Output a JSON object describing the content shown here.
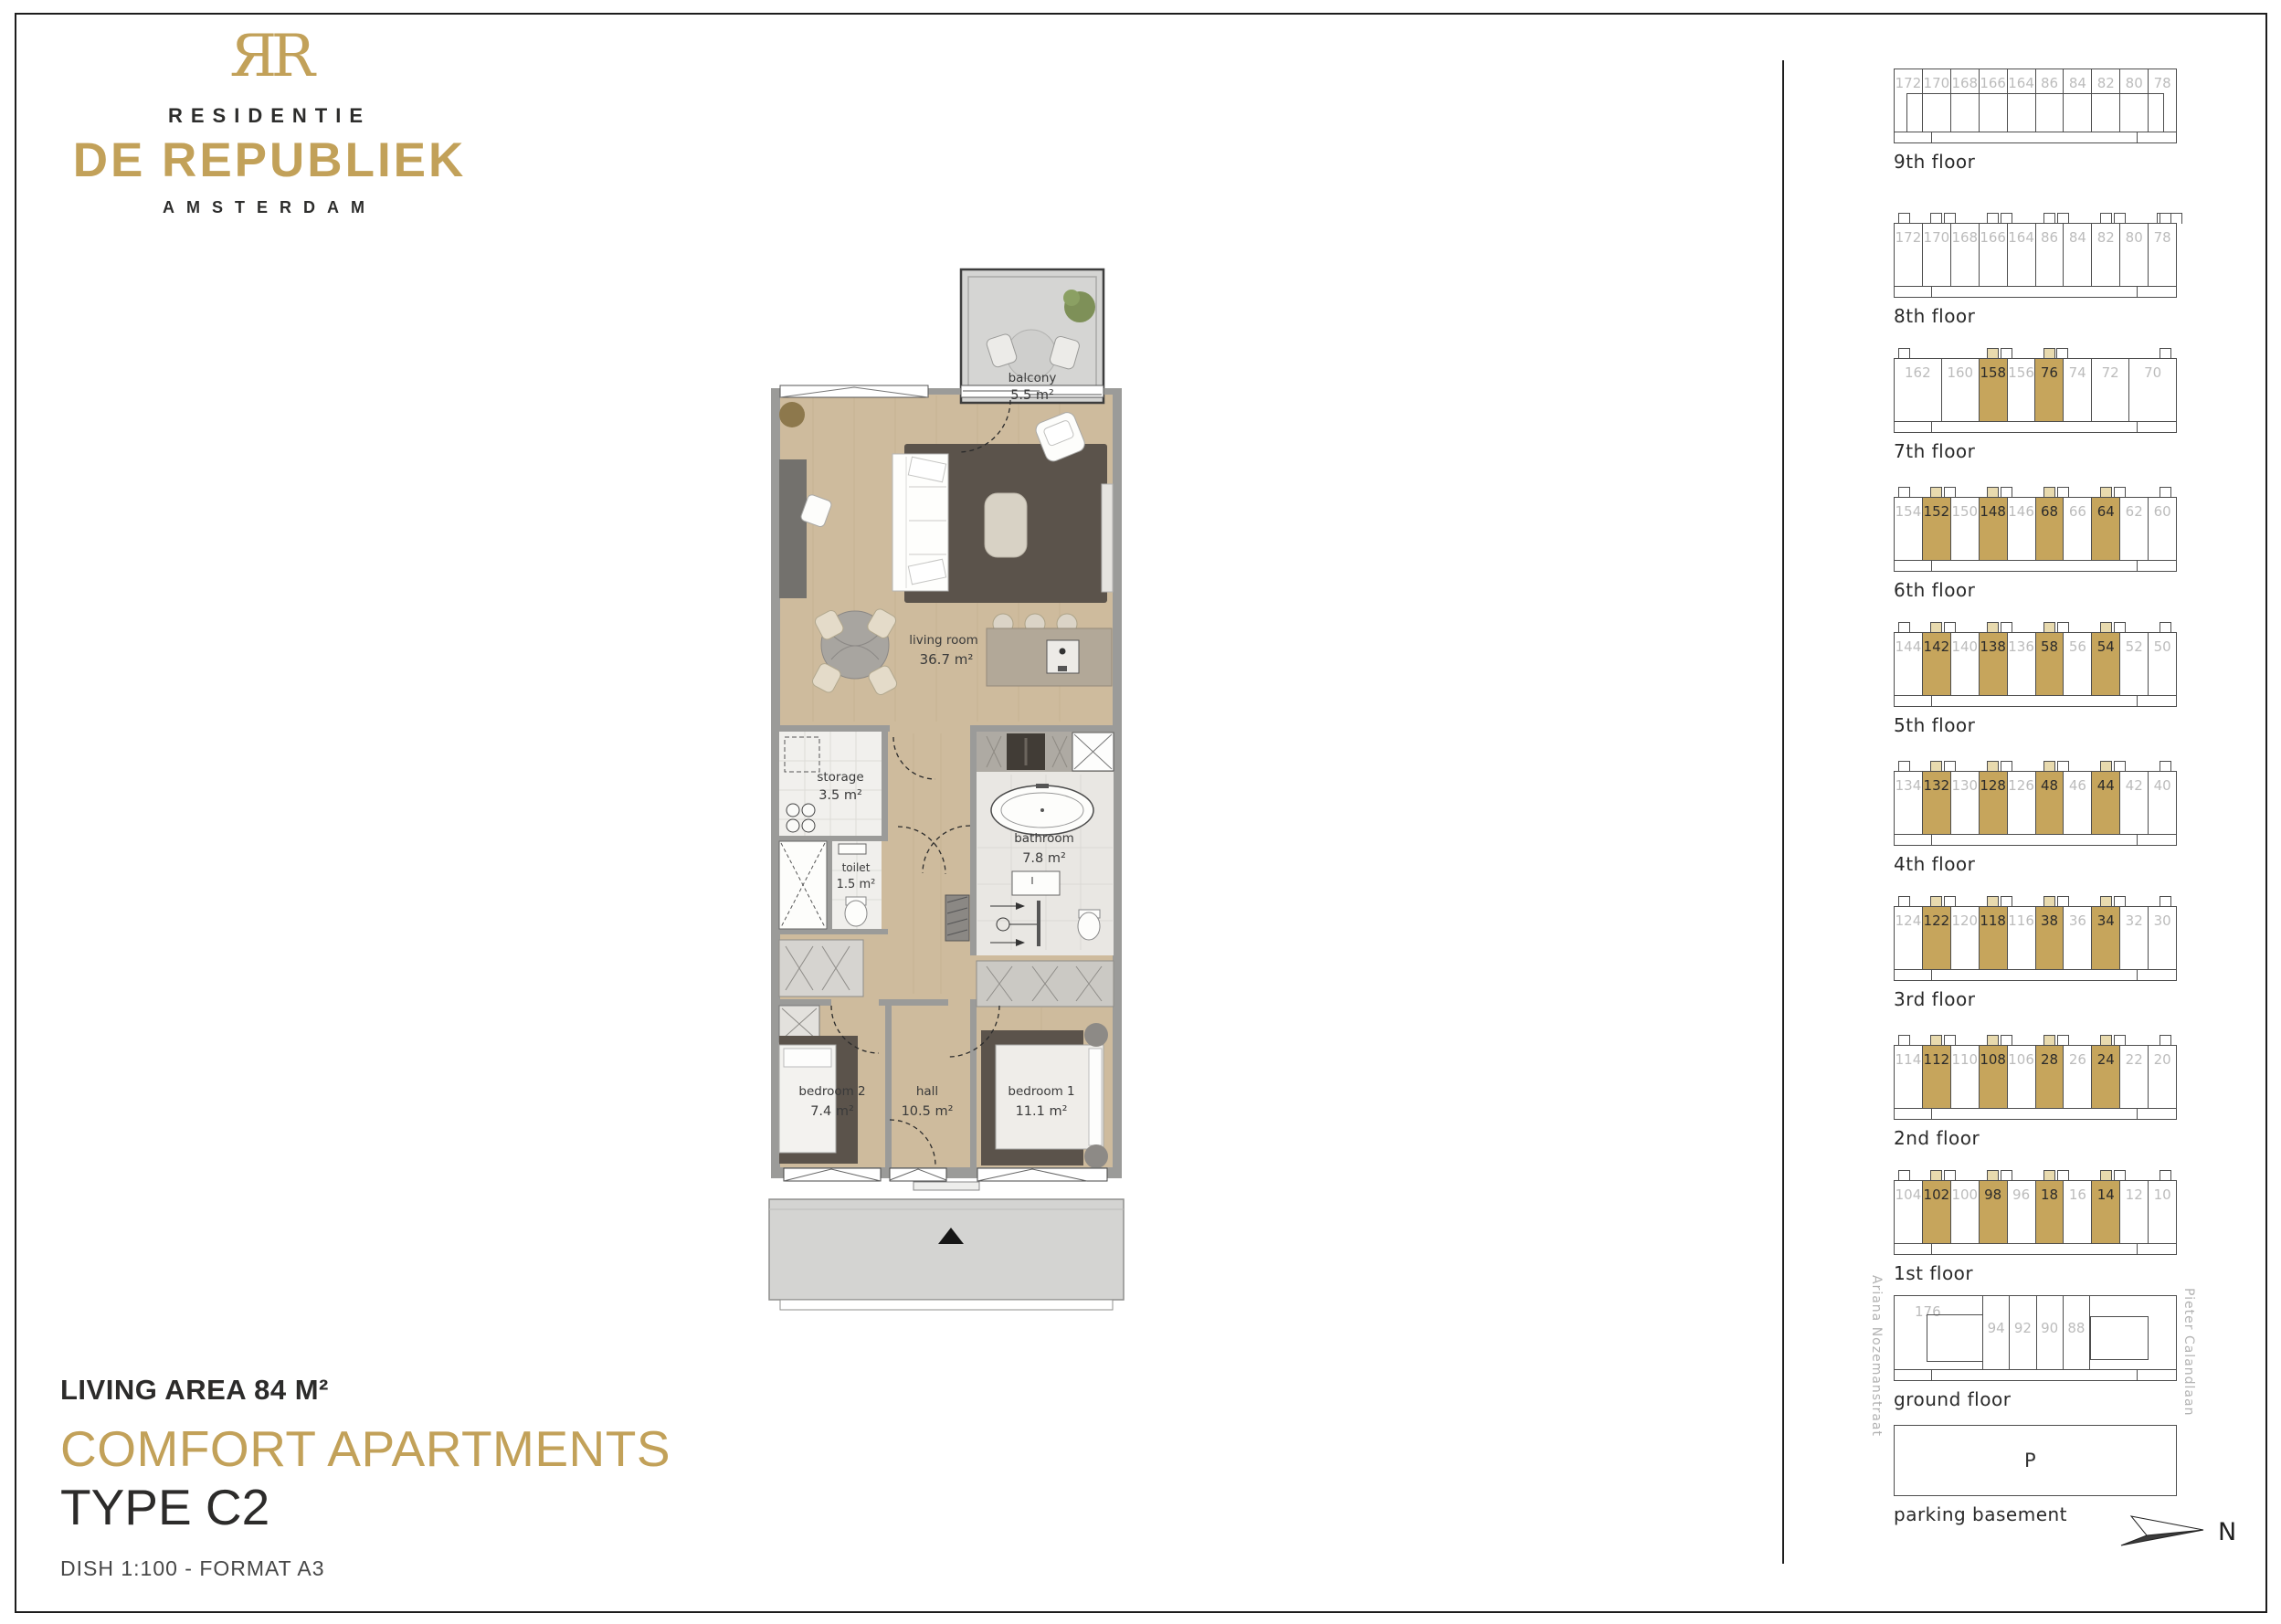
{
  "brand": {
    "monogram": "ЯR",
    "residence": "RESIDENTIE",
    "name": "DE REPUBLIEK",
    "city": "AMSTERDAM"
  },
  "title_block": {
    "living_area": "LIVING AREA 84 M²",
    "category": "COMFORT APARTMENTS",
    "type": "TYPE C2",
    "scale_note": "DISH 1:100  -  FORMAT A3"
  },
  "colors": {
    "gold": "#C2A159",
    "gold_cell": "#C6A55C",
    "gold_bump": "#E8DAAE",
    "gray_number": "#BCBCBC",
    "dark_text": "#2C2B2A"
  },
  "plan": {
    "rooms": {
      "balcony": {
        "name": "balcony",
        "area": "5.5 m²"
      },
      "living": {
        "name": "living room",
        "area": "36.7 m²"
      },
      "storage": {
        "name": "storage",
        "area": "3.5 m²"
      },
      "toilet": {
        "name": "toilet",
        "area": "1.5 m²"
      },
      "bathroom": {
        "name": "bathroom",
        "area": "7.8 m²"
      },
      "bedroom2": {
        "name": "bedroom 2",
        "area": "7.4 m²"
      },
      "hall": {
        "name": "hall",
        "area": "10.5 m²"
      },
      "bedroom1": {
        "name": "bedroom 1",
        "area": "11.1 m²"
      }
    }
  },
  "sidebar": {
    "streets": {
      "left": "Ariana Nozemanstraat",
      "right": "Pieter Calandlaan"
    },
    "north_label": "N",
    "floors": [
      {
        "label": "9th floor",
        "type": "ninth",
        "cells": [
          {
            "n": "172"
          },
          {
            "n": "170"
          },
          {
            "n": "168"
          },
          {
            "n": "166"
          },
          {
            "n": "164"
          },
          {
            "n": "86"
          },
          {
            "n": "84"
          },
          {
            "n": "82"
          },
          {
            "n": "80"
          },
          {
            "n": "78"
          }
        ]
      },
      {
        "label": "8th floor",
        "type": "standard",
        "cells": [
          {
            "n": "172"
          },
          {
            "n": "170"
          },
          {
            "n": "168"
          },
          {
            "n": "166"
          },
          {
            "n": "164"
          },
          {
            "n": "86"
          },
          {
            "n": "84"
          },
          {
            "n": "82"
          },
          {
            "n": "80"
          },
          {
            "n": "78"
          }
        ]
      },
      {
        "label": "7th floor",
        "type": "standard",
        "cells": [
          {
            "n": "162",
            "w": 1.7
          },
          {
            "n": "160",
            "w": 1.35
          },
          {
            "n": "158",
            "hl": true
          },
          {
            "n": "156"
          },
          {
            "n": "76",
            "hl": true
          },
          {
            "n": "74"
          },
          {
            "n": "72",
            "w": 1.35
          },
          {
            "n": "70",
            "w": 1.7
          }
        ]
      },
      {
        "label": "6th floor",
        "type": "standard",
        "cells": [
          {
            "n": "154"
          },
          {
            "n": "152",
            "hl": true
          },
          {
            "n": "150"
          },
          {
            "n": "148",
            "hl": true
          },
          {
            "n": "146"
          },
          {
            "n": "68",
            "hl": true
          },
          {
            "n": "66"
          },
          {
            "n": "64",
            "hl": true
          },
          {
            "n": "62"
          },
          {
            "n": "60"
          }
        ]
      },
      {
        "label": "5th floor",
        "type": "standard",
        "cells": [
          {
            "n": "144"
          },
          {
            "n": "142",
            "hl": true
          },
          {
            "n": "140"
          },
          {
            "n": "138",
            "hl": true
          },
          {
            "n": "136"
          },
          {
            "n": "58",
            "hl": true
          },
          {
            "n": "56"
          },
          {
            "n": "54",
            "hl": true
          },
          {
            "n": "52"
          },
          {
            "n": "50"
          }
        ]
      },
      {
        "label": "4th floor",
        "type": "standard",
        "cells": [
          {
            "n": "134"
          },
          {
            "n": "132",
            "hl": true
          },
          {
            "n": "130"
          },
          {
            "n": "128",
            "hl": true
          },
          {
            "n": "126"
          },
          {
            "n": "48",
            "hl": true
          },
          {
            "n": "46"
          },
          {
            "n": "44",
            "hl": true
          },
          {
            "n": "42"
          },
          {
            "n": "40"
          }
        ]
      },
      {
        "label": "3rd floor",
        "type": "standard",
        "cells": [
          {
            "n": "124"
          },
          {
            "n": "122",
            "hl": true
          },
          {
            "n": "120"
          },
          {
            "n": "118",
            "hl": true
          },
          {
            "n": "116"
          },
          {
            "n": "38",
            "hl": true
          },
          {
            "n": "36"
          },
          {
            "n": "34",
            "hl": true
          },
          {
            "n": "32"
          },
          {
            "n": "30"
          }
        ]
      },
      {
        "label": "2nd floor",
        "type": "standard",
        "cells": [
          {
            "n": "114"
          },
          {
            "n": "112",
            "hl": true
          },
          {
            "n": "110"
          },
          {
            "n": "108",
            "hl": true
          },
          {
            "n": "106"
          },
          {
            "n": "28",
            "hl": true
          },
          {
            "n": "26"
          },
          {
            "n": "24",
            "hl": true
          },
          {
            "n": "22"
          },
          {
            "n": "20"
          }
        ]
      },
      {
        "label": "1st floor",
        "type": "standard",
        "cells": [
          {
            "n": "104"
          },
          {
            "n": "102",
            "hl": true
          },
          {
            "n": "100"
          },
          {
            "n": "98",
            "hl": true
          },
          {
            "n": "96"
          },
          {
            "n": "18",
            "hl": true
          },
          {
            "n": "16"
          },
          {
            "n": "14",
            "hl": true
          },
          {
            "n": "12"
          },
          {
            "n": "10"
          }
        ]
      },
      {
        "label": "ground floor",
        "type": "ground",
        "cells": [
          {
            "n": "176"
          },
          {
            "n": "94"
          },
          {
            "n": "92"
          },
          {
            "n": "90"
          },
          {
            "n": "88"
          }
        ]
      },
      {
        "label": "parking basement",
        "type": "parking",
        "p": "P"
      }
    ]
  }
}
